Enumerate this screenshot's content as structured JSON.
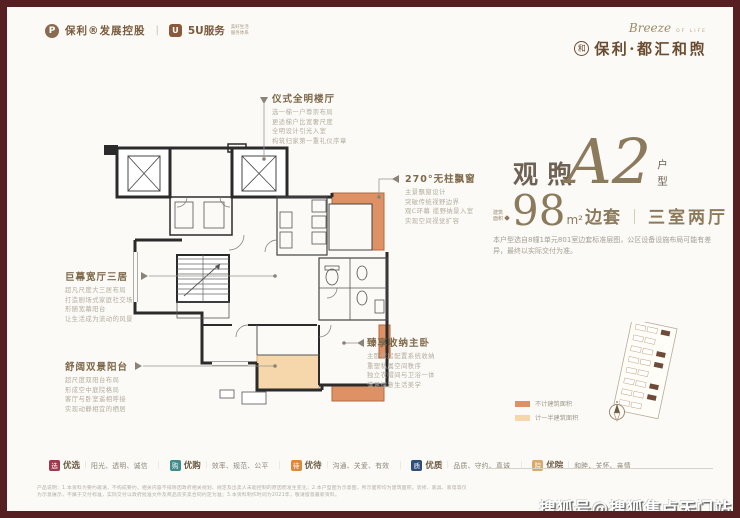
{
  "header": {
    "left": {
      "logo_char": "P",
      "brand1": "保利®发展控股",
      "divider": "|",
      "logo2_char": "U",
      "brand2": "5U服务",
      "brand2_note_l1": "美好生活",
      "brand2_note_l2": "服务体系"
    },
    "right": {
      "script": "Breeze",
      "script_sub": "OF LIFE",
      "ring_char": "和",
      "project_name": "保利·都汇和煦"
    }
  },
  "callouts": [
    {
      "title": "仪式全明楼厅",
      "lines": [
        "选一梯一户尊崇布局",
        "更适梯户比宽奢尺度",
        "全明设计引光入室",
        "构筑归家第一重礼仪序章"
      ]
    },
    {
      "title": "270°无柱飘窗",
      "lines": [
        "主景飘窗设计",
        "突破传统视野边界",
        "观C环幕 揽野纳景入室",
        "实现空间视觉扩容"
      ]
    },
    {
      "title": "巨幕宽厅三居",
      "lines": [
        "超凡尺度大三居布局",
        "打造剧场式家庭社交场",
        "形随宽幕阳台",
        "让生活成为流动的风景"
      ]
    },
    {
      "title": "舒阔双景阳台",
      "lines": [
        "超尺度双阳台布局",
        "形成空中庭院格局",
        "客厅与卧室遥相呼接",
        "实现动静相宜的栖居"
      ]
    },
    {
      "title": "臻享收纳主卧",
      "lines": [
        "主卧套房配置系统收纳",
        "重塑私属空间秩序",
        "独立衣帽间与卫浴一体",
        "满足惬意生活美学"
      ]
    }
  ],
  "spec": {
    "name_cn": "观煦",
    "model": "A2",
    "type_label": "户型",
    "area_label_l1": "建筑",
    "area_label_l2": "面积",
    "area_value": "98",
    "area_unit": "m²",
    "area_tag": "边套",
    "divider": "｜",
    "layout": "三室两厅",
    "description": "本户型选自8幢1单元801室边套标准层图，公区设备设施布局可能有差异，最终以实际交付为准。"
  },
  "legend": [
    {
      "label": "不计建筑面积",
      "color": "#de9165"
    },
    {
      "label": "计一半建筑面积",
      "color": "#f5d7ab"
    }
  ],
  "features": [
    {
      "icon_char": "选",
      "icon_color": "#9e3a4c",
      "name": "优选",
      "bar": "｜",
      "desc": "阳光、透明、诚信"
    },
    {
      "icon_char": "购",
      "icon_color": "#3f8d8a",
      "name": "优购",
      "bar": "｜",
      "desc": "效率、规范、公平"
    },
    {
      "icon_char": "待",
      "icon_color": "#d98a3f",
      "name": "优待",
      "bar": "｜",
      "desc": "沟通、关爱、有效"
    },
    {
      "icon_char": "质",
      "icon_color": "#2e4d7b",
      "name": "优质",
      "bar": "｜",
      "desc": "品质、守约、真诚"
    },
    {
      "icon_char": "院",
      "icon_color": "#d9a96a",
      "name": "优院",
      "bar": "｜",
      "desc": "和睦、关怀、亲情"
    }
  ],
  "feature_separator": "｜",
  "disclaimer": "产品说明：1.本资料为要约邀请，不构成要约，相关内容不排除因政府相关规划、规定及出卖人未能控制的原因而发生变化；2.本户型图为示意图，所示面积均为建筑面积，装修、家具、家电等仅为示意展示，不属于交付标准，实际交付以政府批准文件及商品房买卖合同约定为准；3.本资料制作时间为2021年，敬请留意最新资料。",
  "watermark": "搜狐号@搜狐焦点天门站",
  "colors": {
    "frame": "#561f21",
    "accent_gold": "#8c7a5c",
    "brand_brown": "#6b4c30",
    "orange_full": "#de9165",
    "orange_half": "#f5d7ab"
  }
}
